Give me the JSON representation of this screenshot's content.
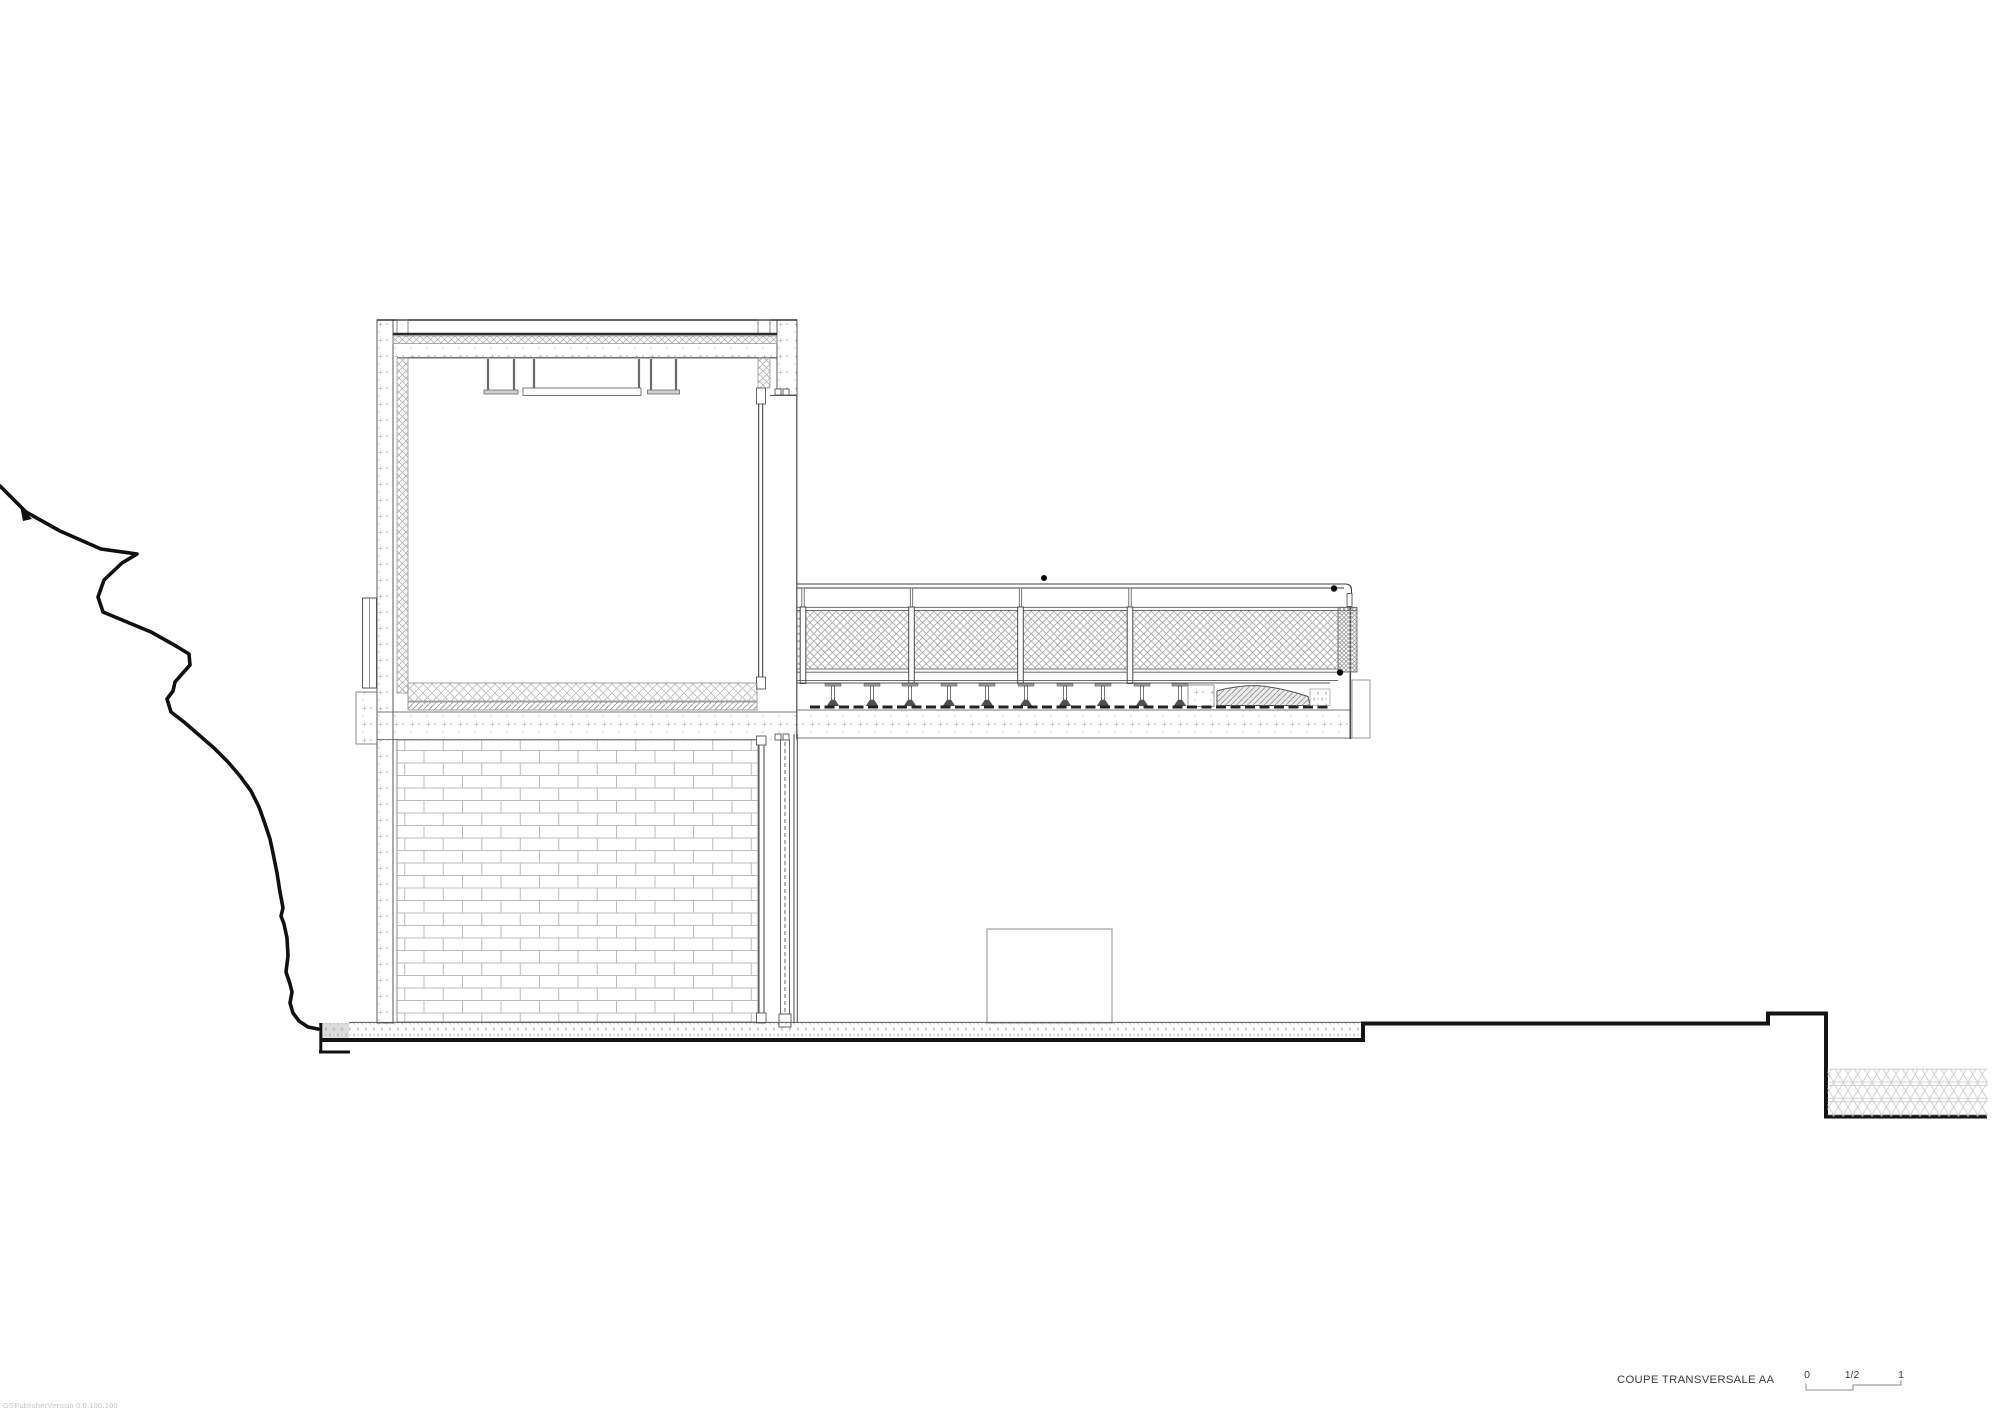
{
  "sheet": {
    "title": "COUPE TRANSVERSALE AA",
    "scale_bar": {
      "zero": "0",
      "half": "1/2",
      "one": "1"
    },
    "watermark": "GSPublisherVersion 0.0.100.100"
  },
  "drawing": {
    "type": "architectural-cross-section",
    "elements": [
      "terrain-profile-left",
      "upper-floor-volume-with-flat-roof",
      "full-height-glazing-right",
      "terrace-with-mesh-guardrail-and-deck-joists",
      "lower-floor-brick-wall-with-door",
      "ground-slab-and-excavation-pit-right"
    ]
  },
  "colors": {
    "paper": "#ffffff",
    "ink": "#161616",
    "line_medium": "#4a4a4a",
    "line_light": "#b5b5b5",
    "hatch": "#a8a8a8",
    "wedge_fill": "#ececec",
    "patch_fill": "#dcdcdc"
  }
}
